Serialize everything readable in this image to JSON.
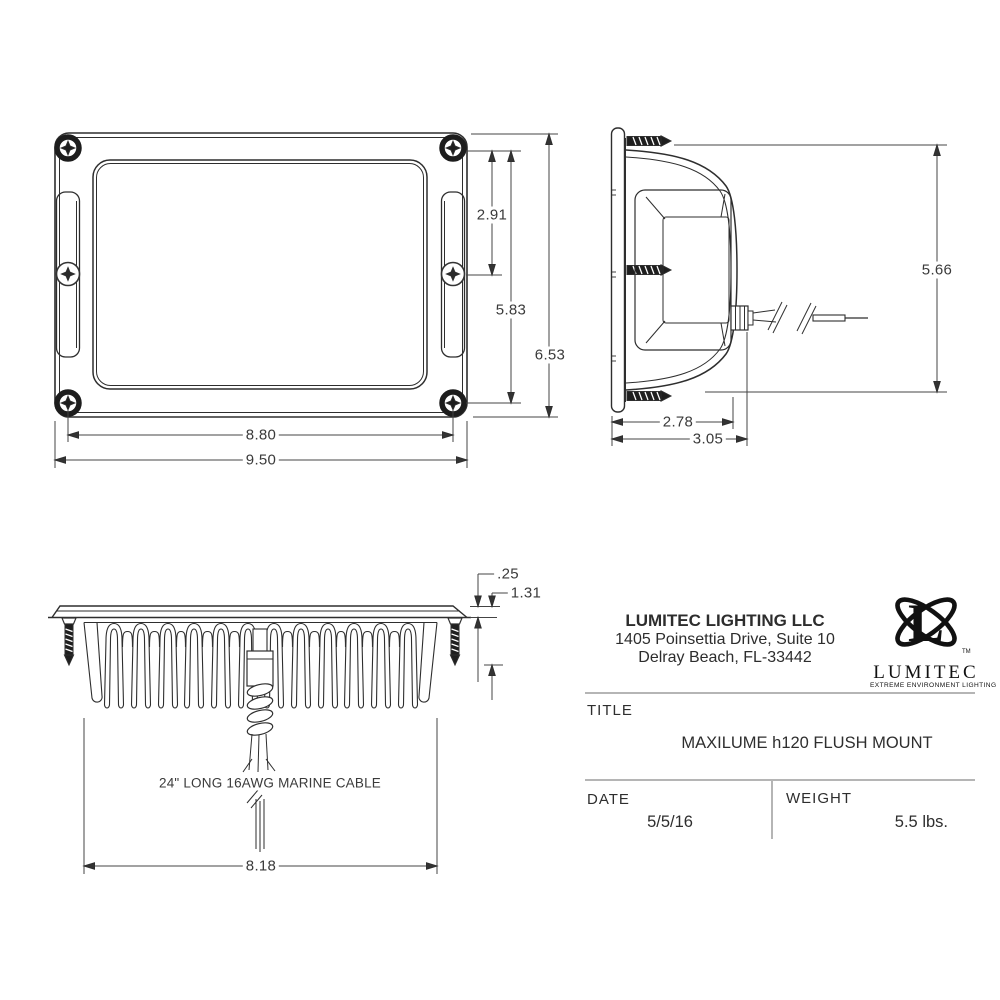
{
  "front_view": {
    "labels": {
      "inner_screw_spacing": "2.91",
      "screw_spacing_v": "5.83",
      "overall_height": "6.53",
      "screw_spacing_h": "8.80",
      "overall_width": "9.50"
    }
  },
  "side_view": {
    "labels": {
      "overall_height": "5.66",
      "body_depth": "2.78",
      "overall_depth": "3.05"
    }
  },
  "bottom_view": {
    "labels": {
      "flange_thickness": ".25",
      "recess_depth": "1.31",
      "heatsink_width": "8.18"
    },
    "cable_note": "24\" LONG 16AWG MARINE CABLE"
  },
  "title_block": {
    "company_name": "LUMITEC LIGHTING LLC",
    "address_line1": "1405 Poinsettia Drive, Suite 10",
    "address_line2": "Delray Beach, FL-33442",
    "logo": {
      "letter": "L",
      "tm": "TM",
      "wordmark": "LUMITEC",
      "tagline": "EXTREME ENVIRONMENT LIGHTING"
    },
    "title_label": "TITLE",
    "title_value": "MAXILUME h120 FLUSH MOUNT",
    "date_label": "DATE",
    "date_value": "5/5/16",
    "weight_label": "WEIGHT",
    "weight_value": "5.5 lbs."
  }
}
